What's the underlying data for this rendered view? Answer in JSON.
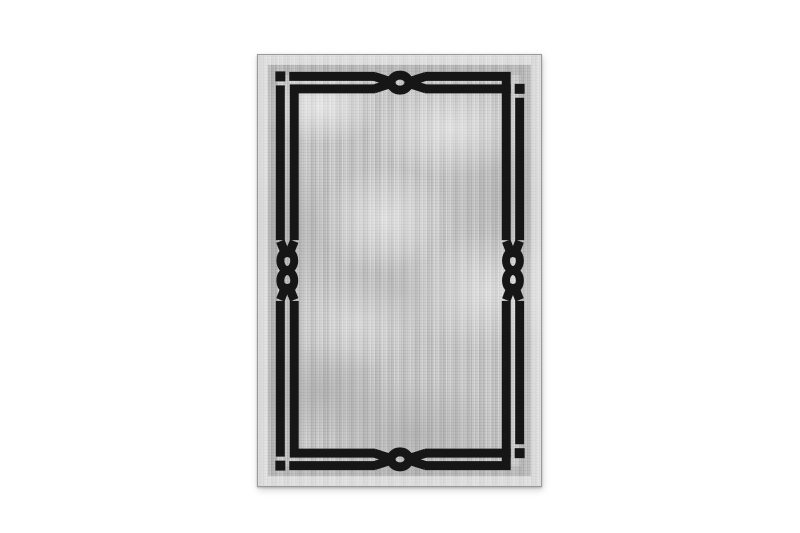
{
  "scene": {
    "type": "product-photo",
    "description": "Light gray distressed-texture area rug on a white background. The rug has a pale woven selvedge edge and a black double-line rectangular border frame. The two border lines interlace: at each corner one line turns a solid right angle while the other terminates in a small detached square bead; at the middle of the top and bottom edges the lines knot into a single chain-link eye motif, and at the middle of the left and right edges they knot into a double figure-eight link motif.",
    "background_color": "#ffffff"
  },
  "colors": {
    "background": "#ffffff",
    "field": "#c6c6c6",
    "selvedge": "#e0e0e0",
    "edge_line": "#9a9a9a",
    "frame": "#161616"
  },
  "rug": {
    "position": {
      "left_px": 257,
      "top_px": 54,
      "width_px": 285,
      "height_px": 433
    },
    "elements": {
      "corner_squares": [
        "top-left",
        "top-right",
        "bottom-right",
        "bottom-left"
      ],
      "single_link_motifs": [
        "top-center",
        "bottom-center"
      ],
      "double_link_motifs": [
        "left-center",
        "right-center"
      ]
    }
  }
}
